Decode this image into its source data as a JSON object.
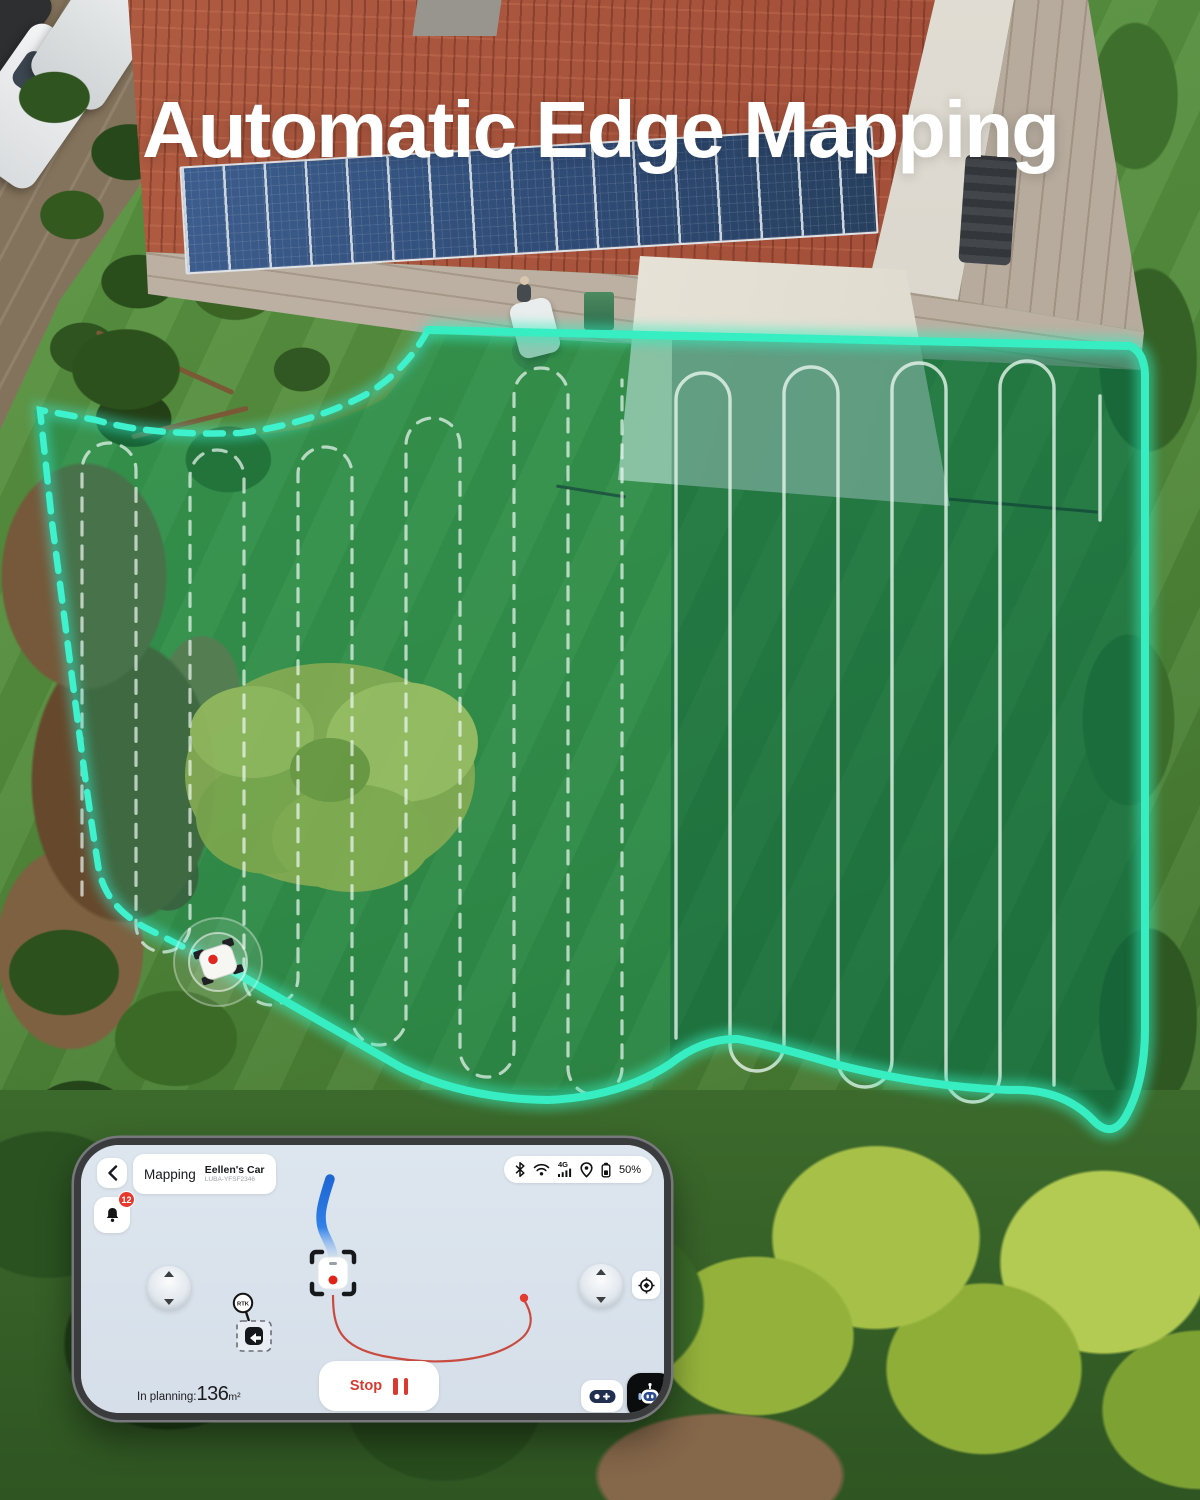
{
  "title": "Automatic Edge Mapping",
  "phone": {
    "header": {
      "mode": "Mapping",
      "device_name": "Eellen's Car",
      "device_id": "LUBA-YFSF2346"
    },
    "status": {
      "network": "4G",
      "battery": "50%"
    },
    "notifications": {
      "count": "12"
    },
    "map": {
      "rtk_label": "RTK"
    },
    "controls": {
      "stop_label": "Stop",
      "planning_label": "In planning:",
      "planning_value": "136",
      "planning_unit": "m²"
    }
  },
  "colors": {
    "boundary_teal": "#35ECBE",
    "boundary_dashed": "#38E8D0",
    "path_blue": "#2E7BDF",
    "path_red": "#D04A3E",
    "alert_red": "#E8392E",
    "lawn_overlay": "rgba(0,150,90,0.40)"
  }
}
